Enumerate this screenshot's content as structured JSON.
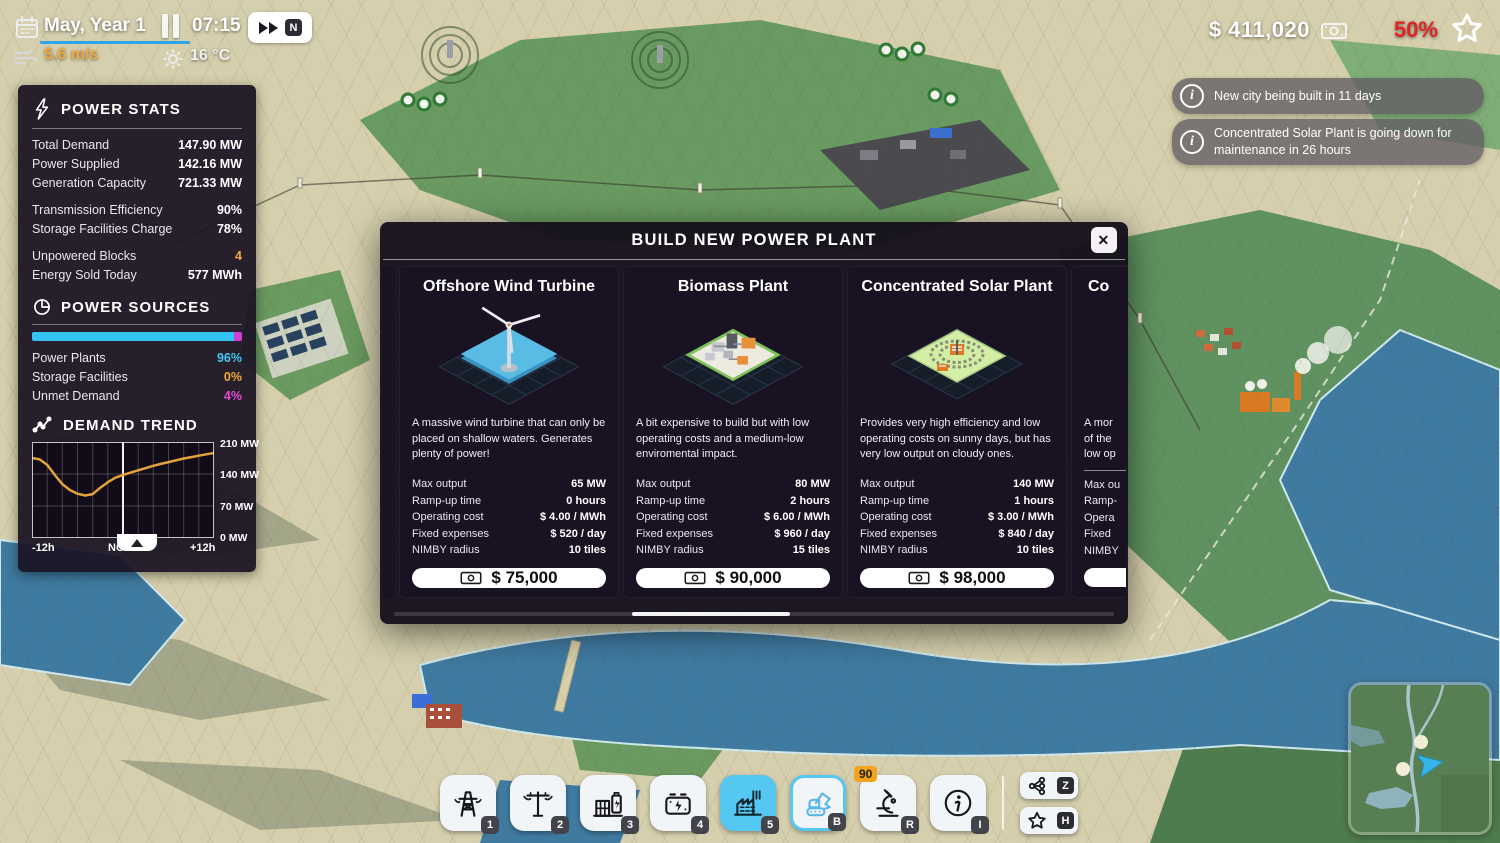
{
  "hud": {
    "date": "May, Year 1",
    "time": "07:15",
    "wind_speed": "5.6 m/s",
    "temperature": "16 °C",
    "speed_badge": "N",
    "money": "$ 411,020",
    "approval": "50%"
  },
  "power_stats": {
    "title": "POWER STATS",
    "rows1": [
      {
        "label": "Total Demand",
        "value": "147.90 MW"
      },
      {
        "label": "Power Supplied",
        "value": "142.16 MW"
      },
      {
        "label": "Generation Capacity",
        "value": "721.33 MW"
      }
    ],
    "rows2": [
      {
        "label": "Transmission Efficiency",
        "value": "90%"
      },
      {
        "label": "Storage Facilities Charge",
        "value": "78%"
      }
    ],
    "rows3": [
      {
        "label": "Unpowered Blocks",
        "value": "4"
      },
      {
        "label": "Energy Sold Today",
        "value": "577 MWh"
      }
    ]
  },
  "power_sources": {
    "title": "POWER SOURCES",
    "bar": {
      "cyan_pct": 96,
      "magenta_pct": 4
    },
    "rows": [
      {
        "label": "Power Plants",
        "value": "96%"
      },
      {
        "label": "Storage Facilities",
        "value": "0%"
      },
      {
        "label": "Unmet Demand",
        "value": "4%"
      }
    ]
  },
  "demand_trend": {
    "title": "DEMAND TREND",
    "y_ticks": [
      "210 MW",
      "140 MW",
      "70 MW",
      "0 MW"
    ],
    "x_ticks": [
      "-12h",
      "NOW",
      "+12h"
    ]
  },
  "chart_data": {
    "type": "line",
    "title": "DEMAND TREND",
    "xlabel": "time (hours relative to now)",
    "ylabel": "MW",
    "ylim": [
      0,
      210
    ],
    "x_tick_labels": [
      "-12h",
      "NOW",
      "+12h"
    ],
    "y_tick_labels": [
      210,
      140,
      70,
      0
    ],
    "line_color": "#e2a33c",
    "now_marker_x": 0,
    "x": [
      -12,
      -11,
      -10,
      -9,
      -8,
      -7,
      -6,
      -5,
      -4,
      -3,
      -2,
      -1,
      0,
      1,
      2,
      3,
      4,
      5,
      6,
      7,
      8,
      9,
      10,
      11,
      12
    ],
    "values": [
      175,
      172,
      160,
      138,
      118,
      105,
      97,
      93,
      96,
      110,
      122,
      132,
      138,
      143,
      148,
      153,
      158,
      162,
      166,
      170,
      174,
      177,
      180,
      183,
      186
    ]
  },
  "notifications": [
    {
      "message": "New city being built in 11 days",
      "icon": "i"
    },
    {
      "message": "Concentrated Solar Plant is going down for maintenance in 26 hours",
      "icon": "i"
    }
  ],
  "modal": {
    "title": "BUILD NEW POWER PLANT",
    "close_icon": "✕",
    "cards": [
      {
        "title": "Offshore Wind Turbine",
        "description": "A massive wind turbine that can only be placed on shallow waters. Generates plenty of power!",
        "stats": [
          {
            "label": "Max output",
            "value": "65 MW"
          },
          {
            "label": "Ramp-up time",
            "value": "0 hours"
          },
          {
            "label": "Operating cost",
            "value": "$ 4.00 / MWh"
          },
          {
            "label": "Fixed expenses",
            "value": "$ 520 / day"
          },
          {
            "label": "NIMBY radius",
            "value": "10 tiles"
          }
        ],
        "price": "$ 75,000"
      },
      {
        "title": "Biomass Plant",
        "description": "A bit expensive to build but with low operating costs and a medium-low enviromental impact.",
        "stats": [
          {
            "label": "Max output",
            "value": "80 MW"
          },
          {
            "label": "Ramp-up time",
            "value": "2 hours"
          },
          {
            "label": "Operating cost",
            "value": "$ 6.00 / MWh"
          },
          {
            "label": "Fixed expenses",
            "value": "$ 960 / day"
          },
          {
            "label": "NIMBY radius",
            "value": "15 tiles"
          }
        ],
        "price": "$ 90,000"
      },
      {
        "title": "Concentrated Solar Plant",
        "description": "Provides very high efficiency and low operating costs on sunny days, but has very low output on cloudy ones.",
        "stats": [
          {
            "label": "Max output",
            "value": "140 MW"
          },
          {
            "label": "Ramp-up time",
            "value": "1 hours"
          },
          {
            "label": "Operating cost",
            "value": "$ 3.00 / MWh"
          },
          {
            "label": "Fixed expenses",
            "value": "$ 840 / day"
          },
          {
            "label": "NIMBY radius",
            "value": "10 tiles"
          }
        ],
        "price": "$ 98,000"
      },
      {
        "title": "Co",
        "description": "A mor\nof the\nlow op",
        "stats": [
          {
            "label": "Max ou",
            "value": ""
          },
          {
            "label": "Ramp-",
            "value": ""
          },
          {
            "label": "Opera",
            "value": ""
          },
          {
            "label": "Fixed",
            "value": ""
          },
          {
            "label": "NIMBY",
            "value": ""
          }
        ],
        "price": ""
      }
    ]
  },
  "toolbar": {
    "buttons": [
      {
        "icon": "transmission-tower",
        "badge": "1"
      },
      {
        "icon": "power-pole",
        "badge": "2"
      },
      {
        "icon": "substation",
        "badge": "3"
      },
      {
        "icon": "battery",
        "badge": "4"
      },
      {
        "icon": "power-plant",
        "badge": "5"
      },
      {
        "icon": "excavator",
        "badge": "B"
      },
      {
        "icon": "microscope",
        "badge": "R",
        "counter": "90"
      },
      {
        "icon": "info",
        "badge": "I"
      }
    ],
    "side_buttons": [
      {
        "icon": "share",
        "badge": "Z"
      },
      {
        "icon": "star",
        "badge": "H"
      }
    ]
  }
}
